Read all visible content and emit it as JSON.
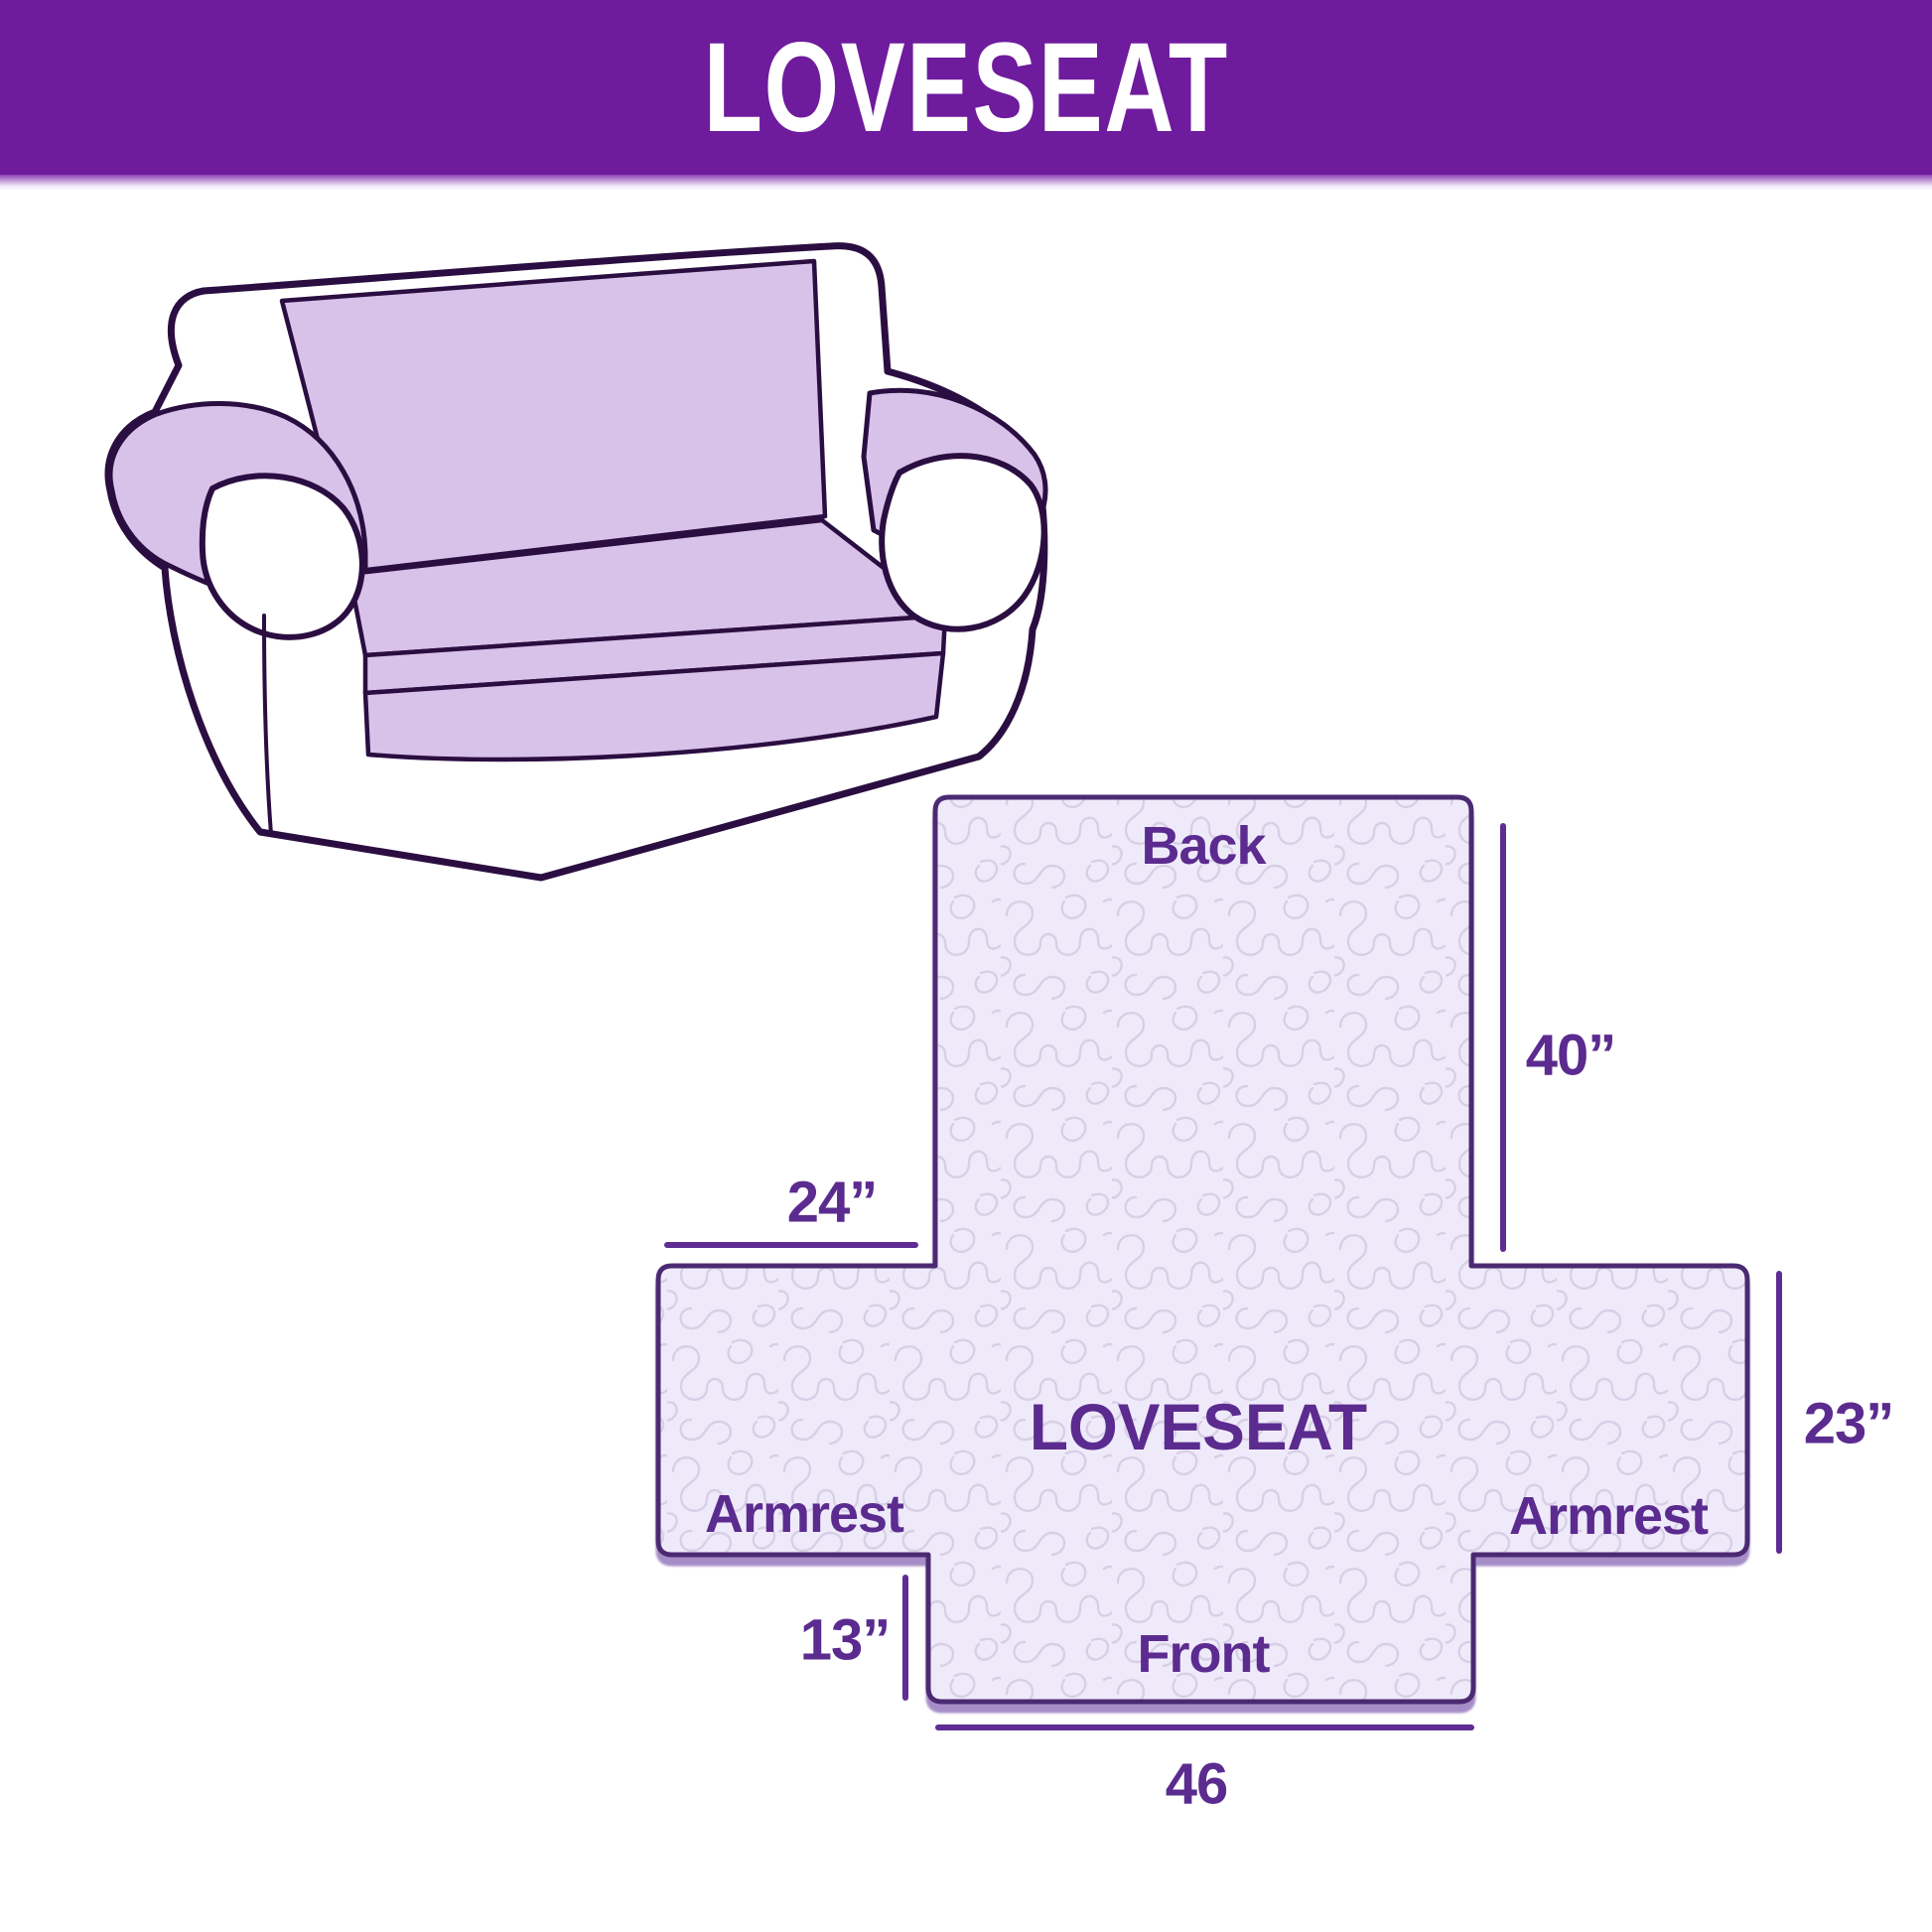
{
  "header": {
    "title": "LOVESEAT"
  },
  "diagram": {
    "center_label": "LOVESEAT",
    "back_label": "Back",
    "front_label": "Front",
    "armrest_left_label": "Armrest",
    "armrest_right_label": "Armrest",
    "dim_back_height": "40”",
    "dim_armrest_top_width": "24”",
    "dim_armrest_side_height": "23”",
    "dim_front_flap_height": "13”",
    "dim_front_width": "46"
  },
  "colors": {
    "header_bg": "#6e1b9d",
    "header_text": "#ffffff",
    "label_text": "#5b2b8f",
    "layout_outline": "#4b2a72",
    "dimension_line": "#5e2c92",
    "quilt_fill": "#efeafa",
    "quilt_stitch": "#d8cfe6",
    "sofa_outline": "#2b0e41",
    "sofa_cover_fill": "#d9c2e9"
  }
}
